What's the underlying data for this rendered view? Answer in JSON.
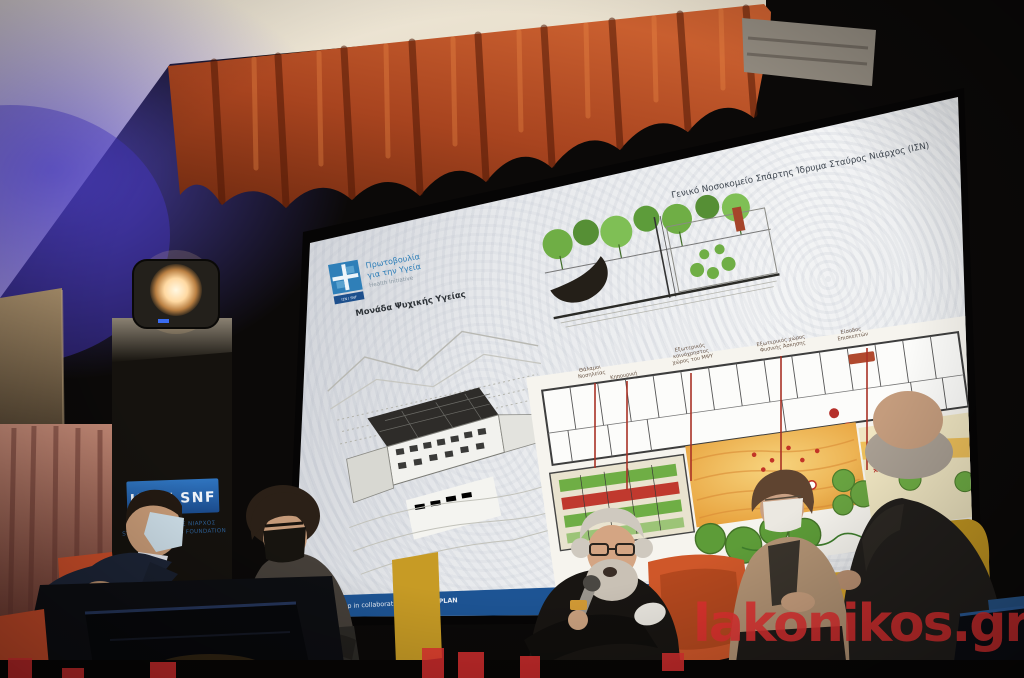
{
  "slide": {
    "title": "Γενικό Νοσοκομείο Σπάρτης Ίδρυμα Σταύρος Νιάρχος (ΙΣΝ)",
    "logo": {
      "line1": "Πρωτοβουλία",
      "line2": "για την Υγεία",
      "line3": "Health Initiative",
      "badge": "ΙΣΝ / SNF"
    },
    "subtitle": "Μονάδα Ψυχικής Υγείας",
    "plan_labels": [
      {
        "lines": [
          "Θάλαμοι",
          "Νοσηλείας"
        ]
      },
      {
        "lines": [
          "Κηπουρική"
        ]
      },
      {
        "lines": [
          "Εξωτερικός",
          "κοινόχρηστος",
          "χώρος του ΜΨΥ"
        ]
      },
      {
        "lines": [
          "Εξωτερικός χώρος",
          "Φυσικής Άσκησης"
        ]
      },
      {
        "lines": [
          "Είσοδος",
          "Επισκεπτών"
        ]
      }
    ],
    "plan_marker": "×",
    "footer": {
      "left_text": "ng Workshop in collaboration with ",
      "left_bold": "BETAPLAN",
      "right_text": "2022"
    }
  },
  "banner": {
    "title": "ΙΣΝ / SNF",
    "line1": "ΙΔΡΥΜΑ ΣΤΑΥΡΟΣ ΝΙΑΡΧΟΣ",
    "line2": "STAVROS NIARCHOS FOUNDATION"
  },
  "watermark": {
    "text": "lakonikos.gr"
  },
  "colors": {
    "slide_bar_blue": "#1d5494",
    "logo_blue": "#2f7fb8",
    "curtain_orange": "#b5512a",
    "chair_orange": "#cc4f28",
    "chair_yellow": "#d2a02a",
    "watermark_red": "#df3030",
    "plan_leader_red": "#a83226"
  }
}
